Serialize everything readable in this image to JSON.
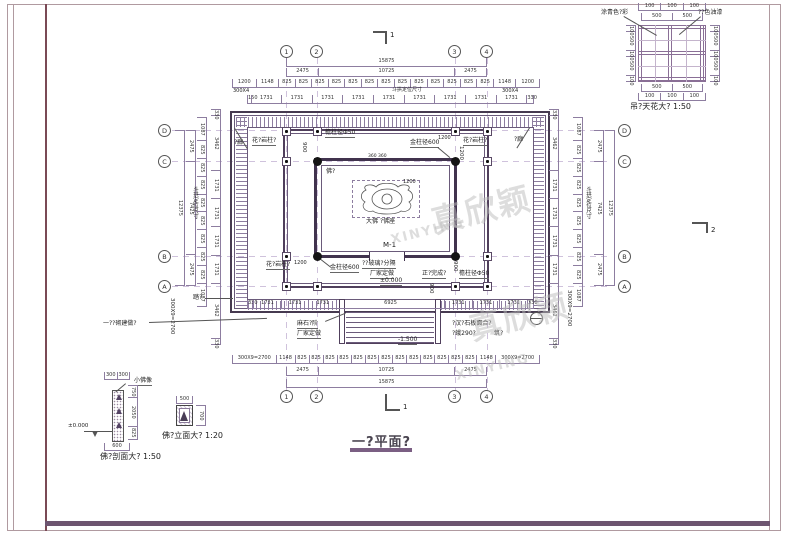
{
  "watermark": {
    "cjk": "真欣颖",
    "latin": "XINYING"
  },
  "title": {
    "text": "一?平面?"
  },
  "section_marks": {
    "top": "1",
    "bottom": "1",
    "right": "2"
  },
  "grid": {
    "cols": [
      "1",
      "2",
      "3",
      "4"
    ],
    "rows": [
      "D",
      "C",
      "B",
      "A"
    ]
  },
  "dims": {
    "top_total": [
      "15875"
    ],
    "top_major": [
      "2475",
      "10725",
      "2475"
    ],
    "top_small": [
      "1200",
      "1148",
      "825",
      "825",
      "825",
      "825",
      "825",
      "825",
      "825",
      "825",
      "825",
      "825",
      "825",
      "825",
      "825",
      "1148",
      "1200"
    ],
    "top_bay": [
      "150",
      "1731",
      "1731",
      "1731",
      "1731",
      "1731",
      "1731",
      "1731",
      "1731",
      "1731",
      "330"
    ],
    "bottom_bay": [
      "330",
      "1731",
      "1731",
      "1731",
      "6925",
      "1731",
      "1731",
      "1731",
      "330"
    ],
    "bottom_small": [
      "300X9=2700",
      "1148",
      "825",
      "825",
      "825",
      "825",
      "825",
      "825",
      "825",
      "825",
      "825",
      "825",
      "825",
      "825",
      "825",
      "1148",
      "300X9=2700"
    ],
    "bottom_major": [
      "2475",
      "10725",
      "2475"
    ],
    "bottom_total": [
      "15875"
    ],
    "left_total": [
      "12375"
    ],
    "left_major": [
      "2475",
      "7425",
      "2475"
    ],
    "left_small": [
      "1087",
      "825",
      "825",
      "825",
      "825",
      "825",
      "825",
      "825",
      "825",
      "1087"
    ],
    "left_bay": [
      "330",
      "3462",
      "1731",
      "1731",
      "1731",
      "1731",
      "3462",
      "330"
    ],
    "right_total": [
      "12375"
    ],
    "right_major": [
      "2475",
      "7425",
      "2475"
    ],
    "right_small": [
      "1087",
      "825",
      "825",
      "825",
      "825",
      "825",
      "825",
      "825",
      "825",
      "1087"
    ],
    "right_bay": [
      "330",
      "3462",
      "1731",
      "1731",
      "1731",
      "1731",
      "3462",
      "330"
    ],
    "eave_note_left": "300X4",
    "eave_note_right": "300X4",
    "bracket_note_top": "斗拱定位尺寸",
    "bracket_note_left": "斗拱定位尺寸",
    "bracket_note_right": "斗拱定位尺寸",
    "side_note_left": "300X9=2700",
    "side_note_right": "300X9=2700"
  },
  "labels": {
    "corridor_tl": "?廊",
    "corridor_tr": "?廊",
    "granite_col_tl": "花?岩柱?",
    "granite_col_tr": "花?岩柱?",
    "granite_col_bl": "花?岩柱?",
    "eave_col_top": "檐柱径Φ50",
    "eave_col_bottom": "檐柱径Φ50",
    "gold_col_top": "金柱径600",
    "gold_col_bottom": "金柱径600",
    "niche": "佛?",
    "statue": "大佛 ?佛座",
    "door": "M-1",
    "glass_partition": "??玻璃?分隔",
    "custom_made": "厂家定做",
    "custom_made2": "厂家定做",
    "front_finish": "正?完成?",
    "stone_steps": "麻石?阶",
    "stone_paving_1": "?汉?石板面合?",
    "stone_paving_2": "?蛾290?",
    "stone_paving_3": "筑?",
    "masonry_note": "一??砌建做?",
    "step_label": "踏?",
    "level_zero": "±0.000",
    "level_neg": "-1.500",
    "dim_900a": "900",
    "dim_900b": "900",
    "dim_900c": "900",
    "dim_1200a": "1200",
    "dim_1200b": "1200",
    "dim_1200c": "1200",
    "dim_1200d": "1200",
    "dim_360": "360 360"
  },
  "ceiling": {
    "caption": "吊?天花大? 1:50",
    "label_left": "涂青色?彩",
    "label_right": "??色油漆",
    "top_outer": [
      "100",
      "100",
      "100"
    ],
    "top_inner": [
      "500",
      "500"
    ],
    "left_chain": [
      "100",
      "500",
      "100",
      "500",
      "100"
    ],
    "right_chain": [
      "100",
      "500",
      "100",
      "500",
      "100"
    ],
    "bottom_inner": [
      "500",
      "500"
    ],
    "bottom_outer": [
      "100",
      "100",
      "100"
    ]
  },
  "section_detail": {
    "caption": "佛?剖面大? 1:50",
    "top_chain": [
      "300",
      "300"
    ],
    "label": "小佛像",
    "right_chain": [
      "750",
      "2050",
      "825"
    ],
    "bottom_chain": [
      "600"
    ],
    "level": "±0.000"
  },
  "elevation_detail": {
    "caption": "佛?立面大? 1:20",
    "top_chain": [
      "500"
    ],
    "right_chain": [
      "700"
    ]
  }
}
